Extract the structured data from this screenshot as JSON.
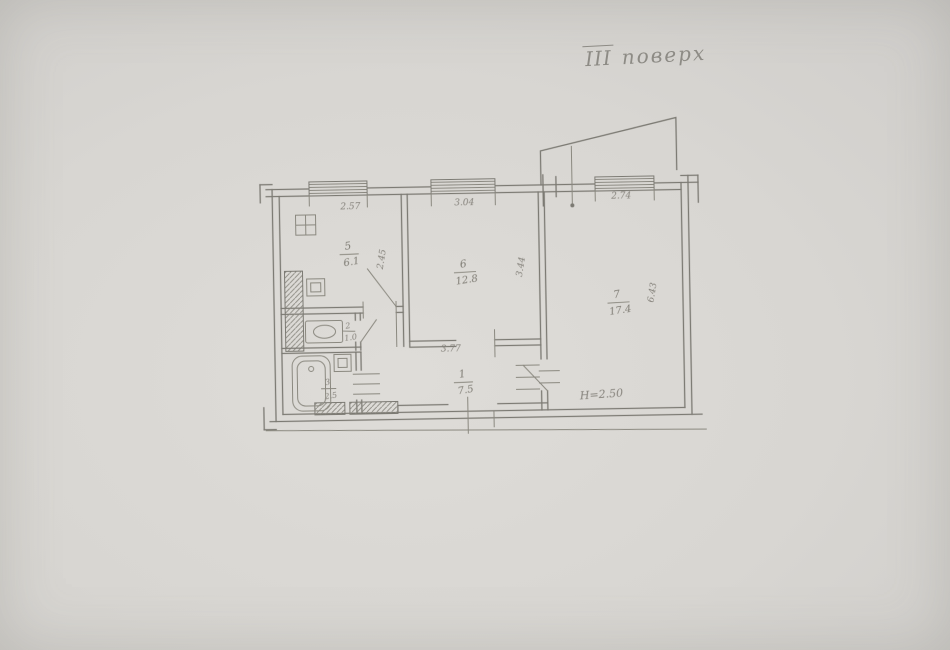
{
  "document": {
    "title": {
      "floor_numeral": "ІІІ",
      "floor_word": "поверх"
    }
  },
  "floor_plan": {
    "rooms": [
      {
        "name": "hallway",
        "number": "1",
        "area": "7.5"
      },
      {
        "name": "wc",
        "number": "2",
        "area": "1.0"
      },
      {
        "name": "bathroom",
        "number": "3",
        "area": "2.5"
      },
      {
        "name": "kitchen",
        "number": "5",
        "area": "6.1"
      },
      {
        "name": "living-room",
        "number": "6",
        "area": "12.8"
      },
      {
        "name": "bedroom",
        "number": "7",
        "area": "17.4"
      }
    ],
    "dimensions": {
      "kitchen_width": "2.57",
      "living_width": "3.04",
      "bedroom_width": "2.74",
      "kitchen_depth": "2.45",
      "living_depth": "3.44",
      "bedroom_depth": "6.43",
      "hallway_width": "3.77",
      "ceiling_height": "Н=2.50"
    },
    "colors": {
      "paper": "#d8d6d2",
      "ink": "#7c7a73"
    }
  }
}
